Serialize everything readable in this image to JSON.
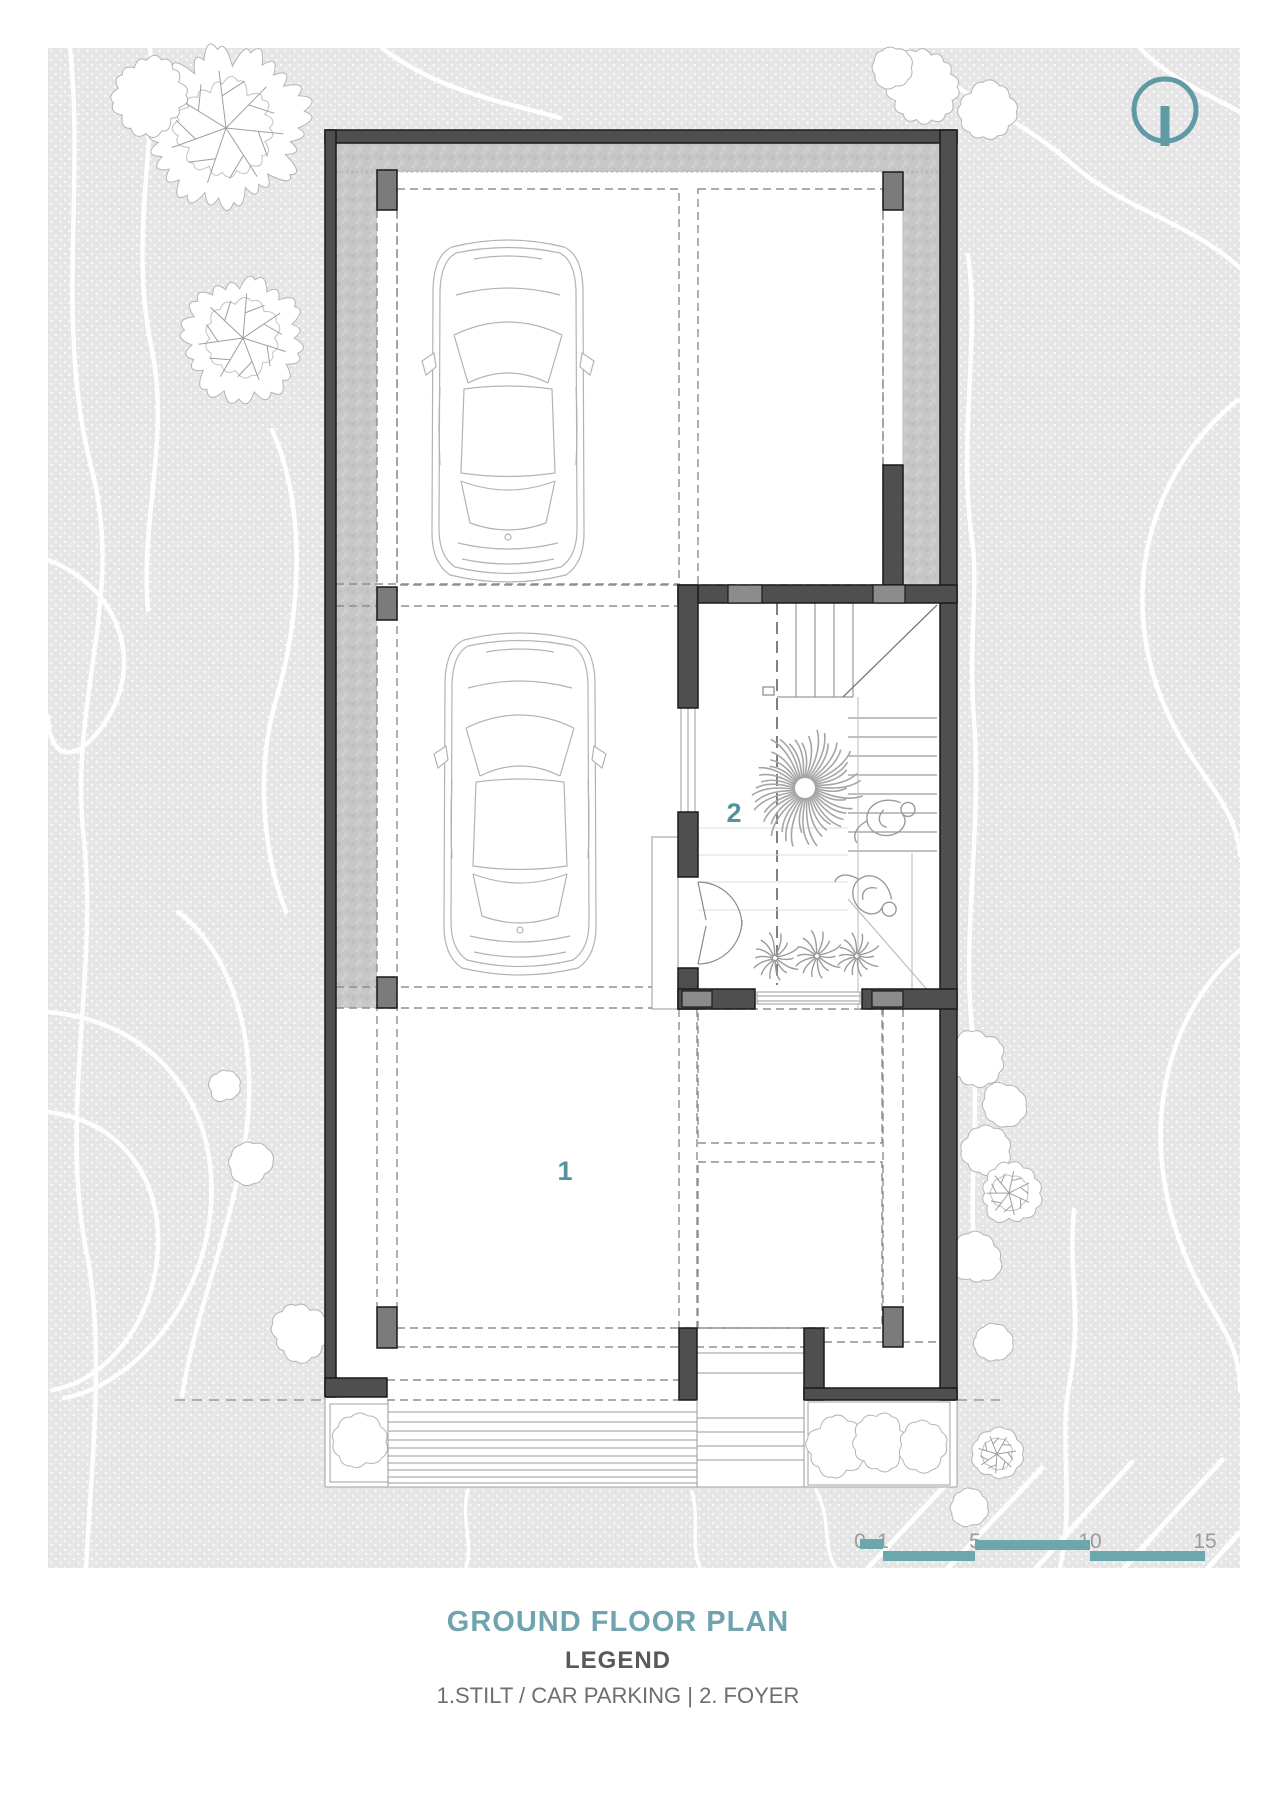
{
  "drawing": {
    "type": "architectural-floor-plan",
    "rooms": [
      {
        "number": "1",
        "name": "Stilt / Car Parking"
      },
      {
        "number": "2",
        "name": "Foyer"
      }
    ]
  },
  "title_block": {
    "plan_title": "GROUND FLOOR PLAN",
    "legend_heading": "LEGEND",
    "legend_line": "1.STILT / CAR PARKING | 2. FOYER"
  },
  "scale_bar": {
    "ticks": [
      "0",
      "1",
      "5",
      "10",
      "15"
    ]
  },
  "icons": {
    "north_arrow": "north-indicator-circle"
  },
  "colors": {
    "accent_teal": "#5f9aa5",
    "title_teal": "#6fa3ad",
    "scale_bar_teal": "#6ba8ae",
    "wall_dark": "#4f4f4f",
    "column_gray": "#7b7b7b",
    "wall_light_block": "#8c8c8c",
    "site_texture": "#e6e6e6",
    "apron_concrete": "#c7c7c7",
    "dashed_line": "#8f8f8f",
    "label_teal": "#55929f"
  }
}
